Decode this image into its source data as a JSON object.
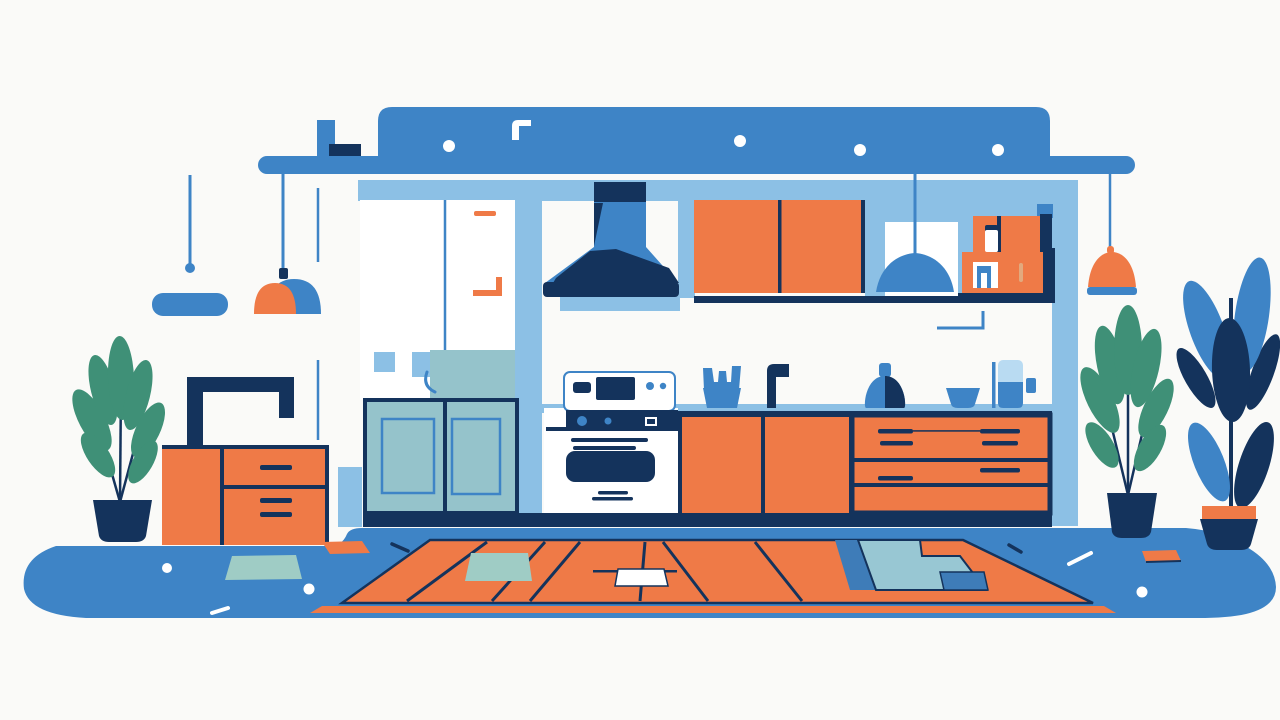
{
  "scene": {
    "description": "Flat vector illustration of a modern kitchen interior in blue, navy and orange: ceiling beam with pendant lamps, range hood over a stove, orange upper and lower cabinets with drawers, wall shelf with jars, refrigerator, sideboard with picture frame, potted plants and a striped orange rug on a blue floor.",
    "objects": [
      "ceiling-beam",
      "pendant-lamps",
      "range-hood",
      "upper-cabinets",
      "wall-shelf",
      "window",
      "refrigerator",
      "stove",
      "lower-cabinets",
      "drawer-unit",
      "countertop-items",
      "sideboard",
      "picture-frame",
      "potted-plants",
      "rug",
      "floor"
    ]
  },
  "palette": {
    "background": "#fafaf8",
    "blue": "#3e84c6",
    "lightBlue": "#8cc0e5",
    "paleBlue": "#b9dbf2",
    "navy": "#14335c",
    "orange": "#ef7a47",
    "teal": "#95c3cb",
    "tealPale": "#9fccc5",
    "tealRug": "#98c7d3",
    "blueMid": "#3e7cb8",
    "green": "#3f9077",
    "white": "#ffffff",
    "tan": "#e2a97e"
  }
}
